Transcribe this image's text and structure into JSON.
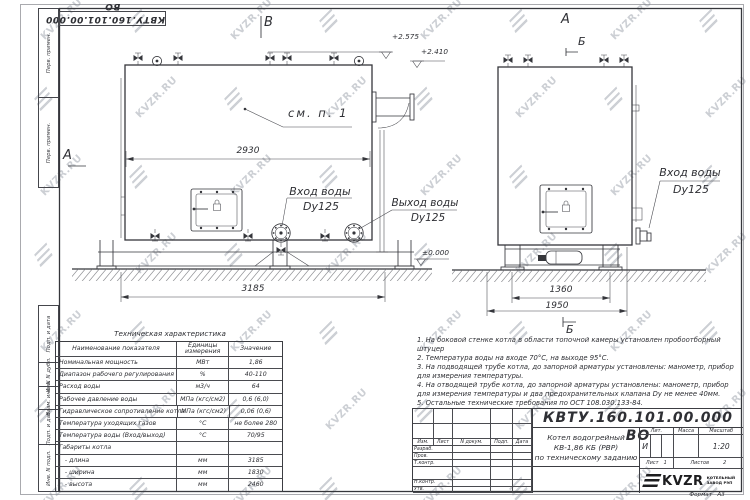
{
  "watermark": {
    "text": "KVZR.RU"
  },
  "margin": {
    "corner_doc_number": "КВТУ.160.101.00.000 ВО",
    "cells": [
      "Перв. примен.",
      "Перв. примен.",
      "Подп. и дата",
      "Инв. N дубл.",
      "Взам. инв. N",
      "Подп. и дата",
      "Инв. N подл."
    ]
  },
  "drawing": {
    "section_a_front": "А",
    "section_b_front": "В",
    "section_a_side": "А",
    "section_b_side_top": "Б",
    "section_b_side_bottom": "Б",
    "callout": "см. п. 1",
    "elev_top": "+2.575",
    "elev_mid": "+2.410",
    "elev_ground": "±0.000",
    "dim_front_body": "2930",
    "dim_front_overall": "3185",
    "dim_side_base": "1360",
    "dim_side_overall": "1950",
    "inlet_front_l1": "Вход воды",
    "inlet_front_l2": "Dy125",
    "outlet_front_l1": "Выход воды",
    "outlet_front_l2": "Dy125",
    "inlet_side_l1": "Вход воды",
    "inlet_side_l2": "Dy125"
  },
  "spec_table": {
    "title": "Техническая характеристика",
    "headers": [
      "Наименование показателя",
      "Единицы измерения",
      "Значение"
    ],
    "rows": [
      [
        "Номинальная мощность",
        "МВт",
        "1,86"
      ],
      [
        "Диапазон рабочего регулирования",
        "%",
        "40-110"
      ],
      [
        "Расход воды",
        "м3/ч",
        "64"
      ],
      [
        "Рабочее давление воды",
        "МПа (кгс/см2)",
        "0,6 (6,0)"
      ],
      [
        "Гидравлическое сопротивление котла",
        "МПа (кгс/см2)",
        "0,06 (0,6)"
      ],
      [
        "Температура уходящих газов",
        "°С",
        "не более 280"
      ],
      [
        "Температура воды (Вход/выход)",
        "°С",
        "70/95"
      ],
      [
        "Габариты котла",
        "",
        ""
      ],
      [
        "   - длина",
        "мм",
        "3185"
      ],
      [
        "   - ширина",
        "мм",
        "1830"
      ],
      [
        "   - высота",
        "мм",
        "2460"
      ]
    ]
  },
  "notes": {
    "items": [
      "1.  На боковой стенке котла в области топочной камеры установлен пробоотборный штуцер",
      "2.  Температура воды на входе  70°С,  на выходе  95°С.",
      "3.  На подводящей трубе котла, до запорной арматуры установлены:  манометр,  прибор для измерения температуры.",
      "4.  На отводящей трубе котла, до запорной арматуры установлены:  манометр,  прибор для измерения температуры и два предохранительных клапана  Dу не менее  40мм.",
      "5.  Остальные технические требования по ОСТ  108.030.133-84."
    ]
  },
  "title_block": {
    "doc_number": "КВТУ.160.101.00.000  ВО",
    "title_lines": [
      "Котел водогрейный",
      "КВ-1,86  КБ  (РВР)",
      "по техническому заданию"
    ],
    "rev_header": [
      "Изм.",
      "Лист",
      "N докум.",
      "Подп.",
      "Дата"
    ],
    "left_rows": [
      "Разраб.",
      "Пров.",
      "Т.контр.",
      "",
      "Н.контр.",
      "Утв."
    ],
    "lit_label": "Лит.",
    "mass_label": "Масса",
    "scale_label": "Масштаб",
    "lit_value": "И",
    "scale_value": "1:20",
    "sheet_label": "Лист",
    "sheet_value": "1",
    "sheets_label": "Листов",
    "sheets_value": "2",
    "logo_text": "KVZR",
    "org_line1": "КОТЕЛЬНЫЙ",
    "org_line2": "ЗАВОД РЭП",
    "format_label": "Формат",
    "format_value": "А3"
  }
}
